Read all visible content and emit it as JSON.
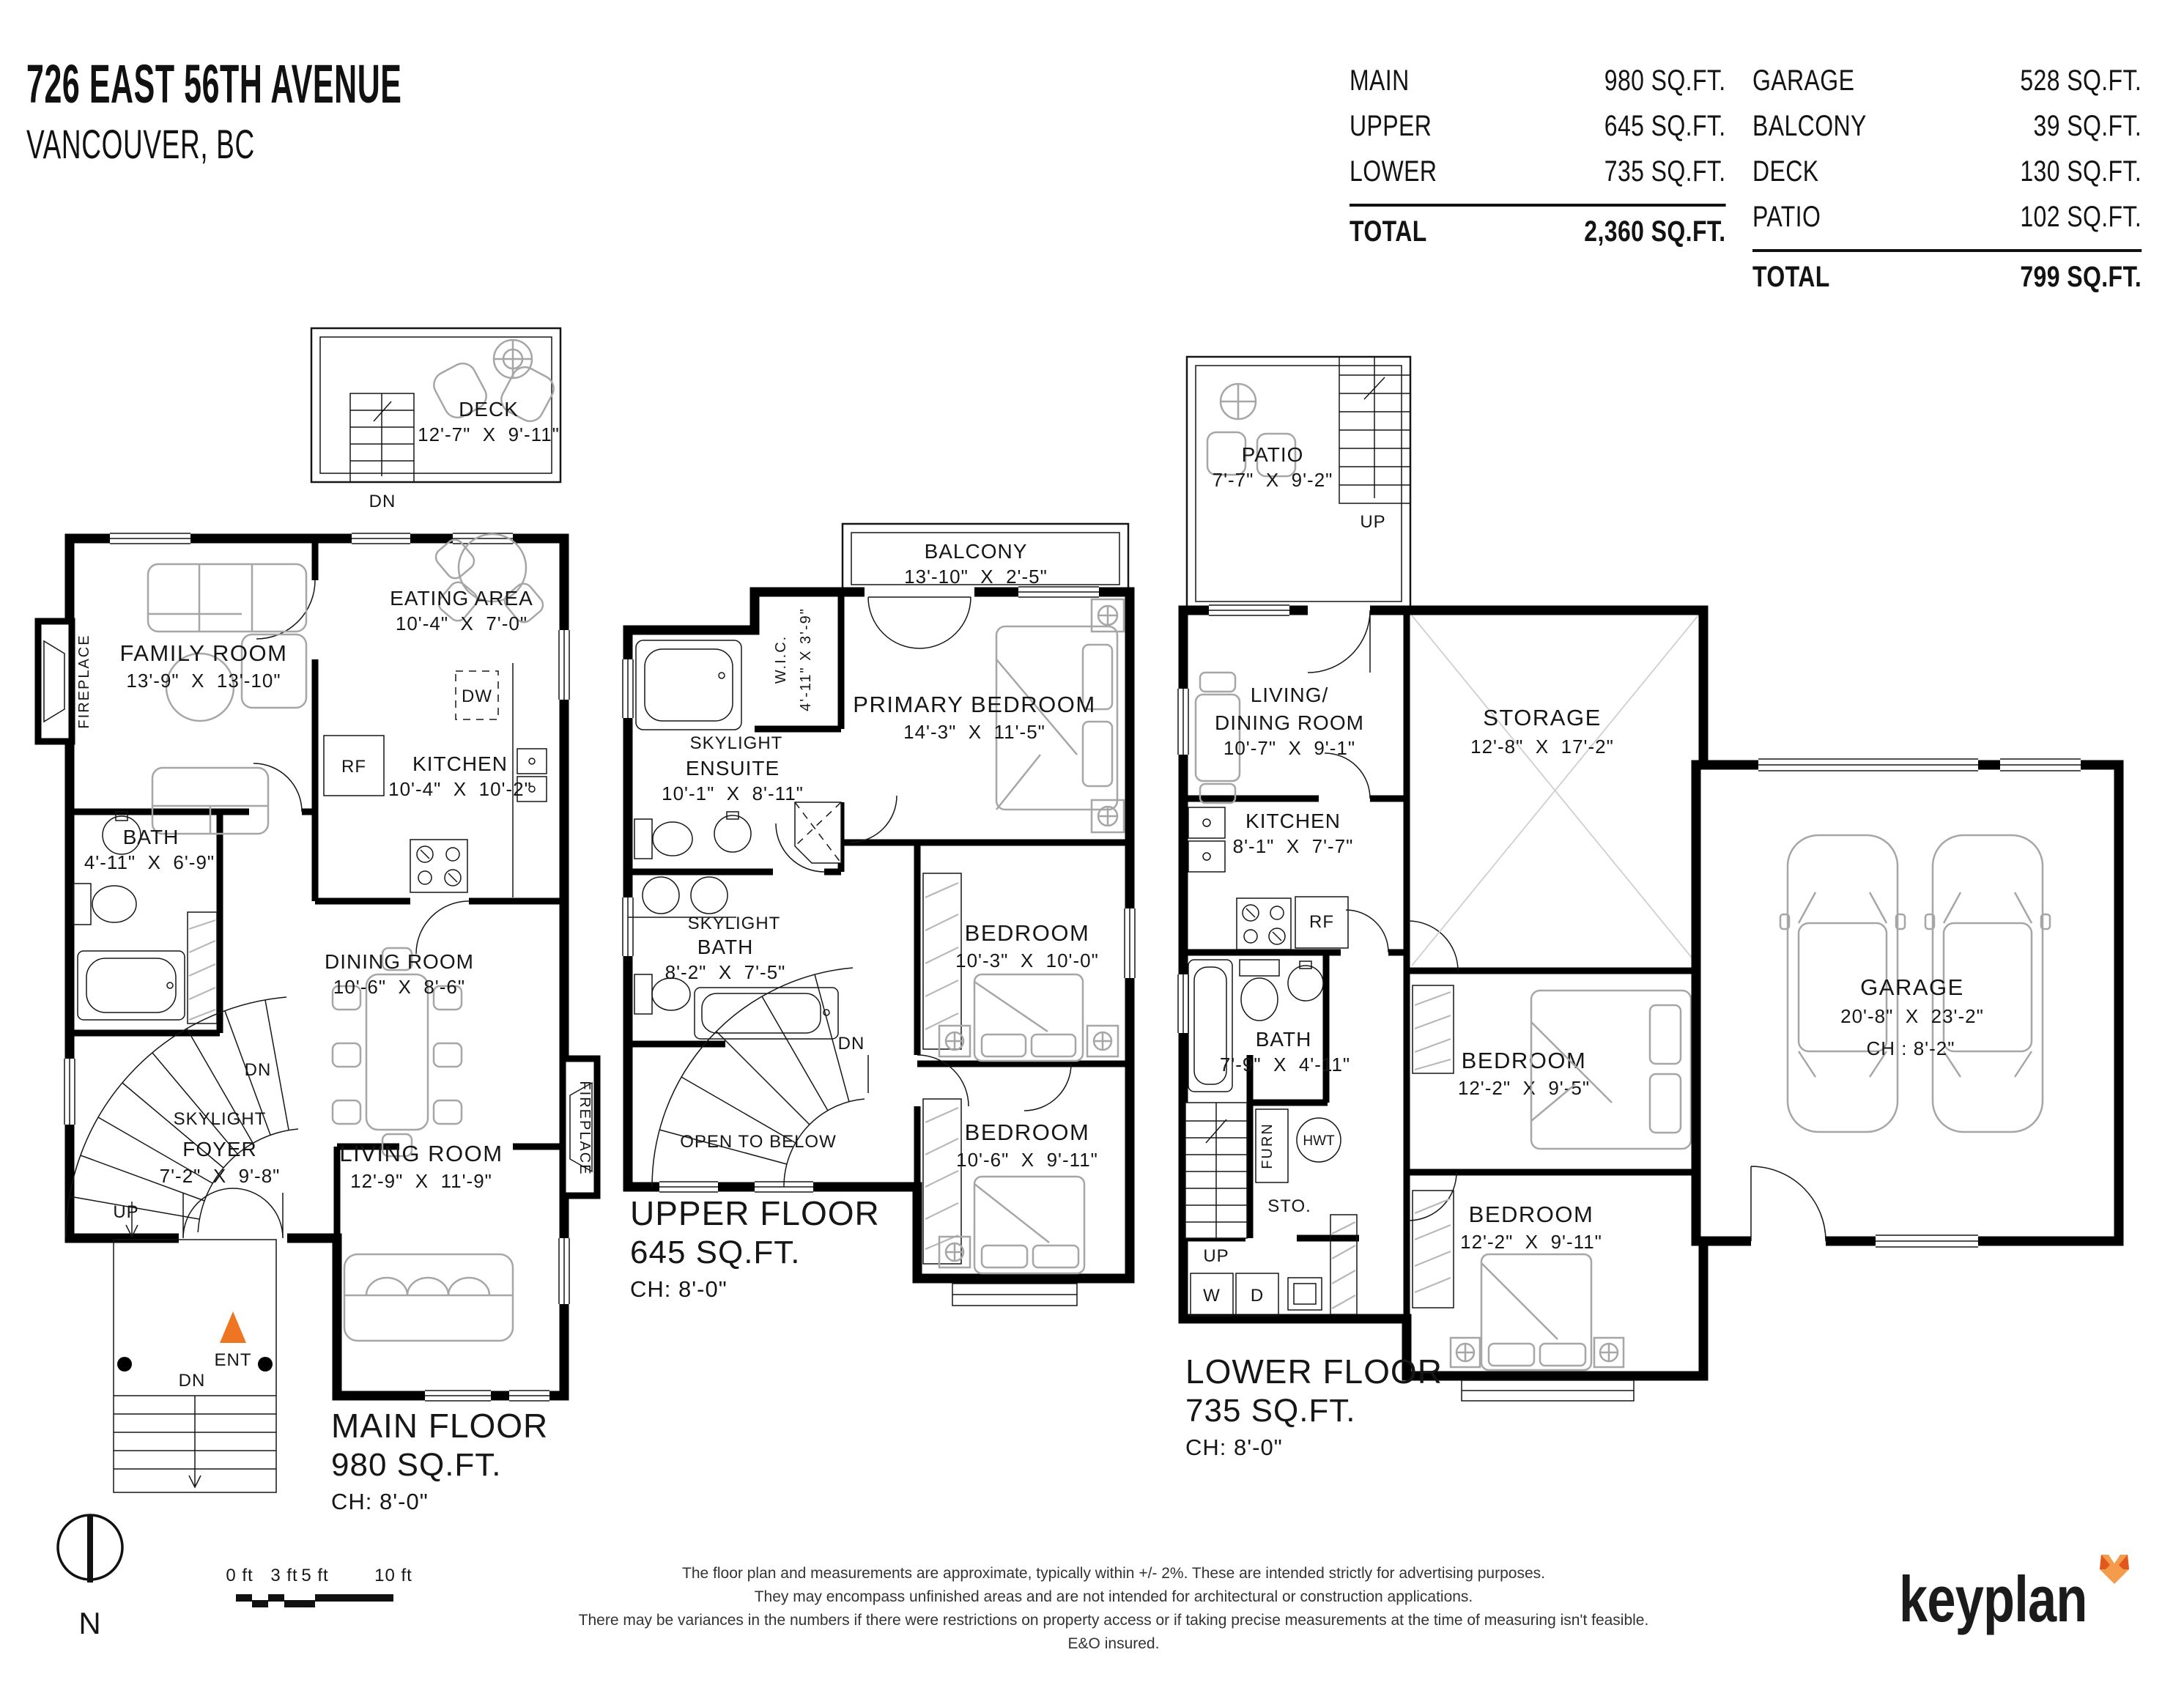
{
  "header": {
    "address": "726 EAST 56TH AVENUE",
    "city": "VANCOUVER, BC"
  },
  "summary": {
    "building": {
      "rows": [
        {
          "label": "MAIN",
          "value": "980 SQ.FT."
        },
        {
          "label": "UPPER",
          "value": "645 SQ.FT."
        },
        {
          "label": "LOWER",
          "value": "735 SQ.FT."
        }
      ],
      "total": {
        "label": "TOTAL",
        "value": "2,360 SQ.FT."
      }
    },
    "outdoor": {
      "rows": [
        {
          "label": "GARAGE",
          "value": "528 SQ.FT."
        },
        {
          "label": "BALCONY",
          "value": "39 SQ.FT."
        },
        {
          "label": "DECK",
          "value": "130 SQ.FT."
        },
        {
          "label": "PATIO",
          "value": "102 SQ.FT."
        }
      ],
      "total": {
        "label": "TOTAL",
        "value": "799 SQ.FT."
      }
    }
  },
  "plans": {
    "main": {
      "title": "MAIN FLOOR",
      "area": "980 SQ.FT.",
      "ch": "CH: 8'-0\"",
      "deck": {
        "n": "DECK",
        "d": "12'-7\"  X  9'-11\""
      },
      "family": {
        "n": "FAMILY ROOM",
        "d": "13'-9\"  X  13'-10\""
      },
      "eating": {
        "n": "EATING AREA",
        "d": "10'-4\"  X  7'-0\""
      },
      "kitchen": {
        "n": "KITCHEN",
        "d": "10'-4\"  X  10'-2\""
      },
      "bath": {
        "n": "BATH",
        "d": "4'-11\"  X  6'-9\""
      },
      "dining": {
        "n": "DINING ROOM",
        "d": "10'-6\"  X  8'-6\""
      },
      "foyer": {
        "n": "FOYER",
        "d": "7'-2\"  X  9'-8\""
      },
      "living": {
        "n": "LIVING ROOM",
        "d": "12'-9\"  X  11'-9\""
      }
    },
    "upper": {
      "title": "UPPER FLOOR",
      "area": "645 SQ.FT.",
      "ch": "CH: 8'-0\"",
      "balcony": {
        "n": "BALCONY",
        "d": "13'-10\"  X  2'-5\""
      },
      "wic": {
        "n": "W.I.C.",
        "d": "4'-11\" X 3'-9\""
      },
      "primary": {
        "n": "PRIMARY BEDROOM",
        "d": "14'-3\"  X  11'-5\""
      },
      "ensuite": {
        "n": "ENSUITE",
        "d": "10'-1\"  X  8'-11\""
      },
      "bath": {
        "n": "BATH",
        "d": "8'-2\"  X  7'-5\""
      },
      "bed2": {
        "n": "BEDROOM",
        "d": "10'-3\"  X  10'-0\""
      },
      "bed3": {
        "n": "BEDROOM",
        "d": "10'-6\"  X  9'-11\""
      },
      "open_below": "OPEN TO BELOW"
    },
    "lower": {
      "title": "LOWER FLOOR",
      "area": "735 SQ.FT.",
      "ch": "CH: 8'-0\"",
      "patio": {
        "n": "PATIO",
        "d": "7'-7\"  X  9'-2\""
      },
      "livdin": {
        "n1": "LIVING/",
        "n2": "DINING ROOM",
        "d": "10'-7\"  X  9'-1\""
      },
      "storage": {
        "n": "STORAGE",
        "d": "12'-8\"  X  17'-2\""
      },
      "kitchen": {
        "n": "KITCHEN",
        "d": "8'-1\"  X  7'-7\""
      },
      "bath": {
        "n": "BATH",
        "d": "7'-9\"  X  4'-11\""
      },
      "bed1": {
        "n": "BEDROOM",
        "d": "12'-2\"  X  9'-5\""
      },
      "bed2": {
        "n": "BEDROOM",
        "d": "12'-2\"  X  9'-11\""
      },
      "sto": "STO.",
      "furn": "FURN",
      "hwt": "HWT",
      "w": "W",
      "d_lbl": "D"
    },
    "garage": {
      "n": "GARAGE",
      "d": "20'-8\"  X  23'-2\"",
      "ch": "CH : 8'-2\""
    },
    "labels": {
      "skylight": "SKYLIGHT",
      "fireplace": "FIREPLACE",
      "dn": "DN",
      "up": "UP",
      "ent": "ENT",
      "dw": "DW",
      "rf": "RF"
    }
  },
  "footer": {
    "north": "N",
    "scale": [
      "0 ft",
      "3 ft",
      "5 ft",
      "10 ft"
    ],
    "disclaimer": [
      "The floor plan and measurements are approximate, typically within +/- 2%. These are intended strictly for advertising purposes.",
      "They may encompass unfinished areas and are not intended for architectural or construction applications.",
      "There may be variances in the numbers if there were restrictions on property access or if taking precise measurements at the time of measuring isn't feasible. E&O insured."
    ],
    "logo": "keyplan"
  },
  "colors": {
    "accent": "#EE7623",
    "fox_light": "#F59B4C",
    "fox_dark": "#E2571B",
    "wall": "#000000"
  }
}
